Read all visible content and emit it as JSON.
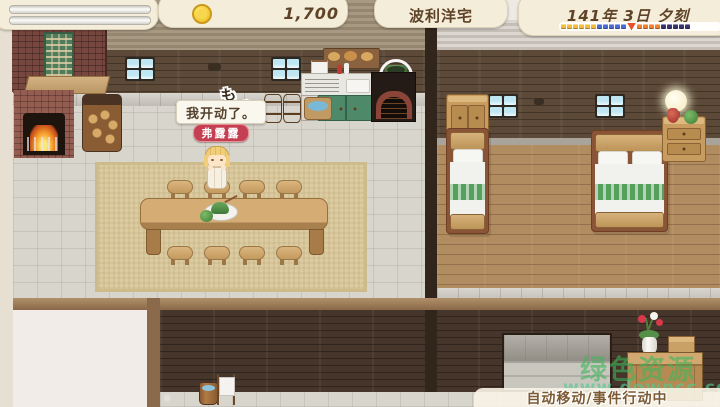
{
  "hud": {
    "money": "1,700",
    "location": "波利洋宅",
    "date": "141年 3日 夕刻",
    "coin_color": "#f3c833",
    "time_bar": {
      "groups": [
        {
          "color": "#f2bc3c",
          "count": 6,
          "marker": false
        },
        {
          "color": "#4a6cd2",
          "count": 5,
          "marker": false
        },
        {
          "color": "#e8502a",
          "count": 1,
          "marker": true
        },
        {
          "color": "#ee8230",
          "count": 4,
          "marker": false
        },
        {
          "color": "#38336e",
          "count": 5,
          "marker": false
        }
      ]
    }
  },
  "dialogue": {
    "speech": "我开动了。",
    "speaker": "弗露露",
    "speaker_tag_color": "#c53f52",
    "sfx": "も",
    "sfx_tail": "く"
  },
  "status_message": "自动移动/事件行动中",
  "watermark": {
    "name": "绿色资源网",
    "url": "www.downcc.com"
  }
}
